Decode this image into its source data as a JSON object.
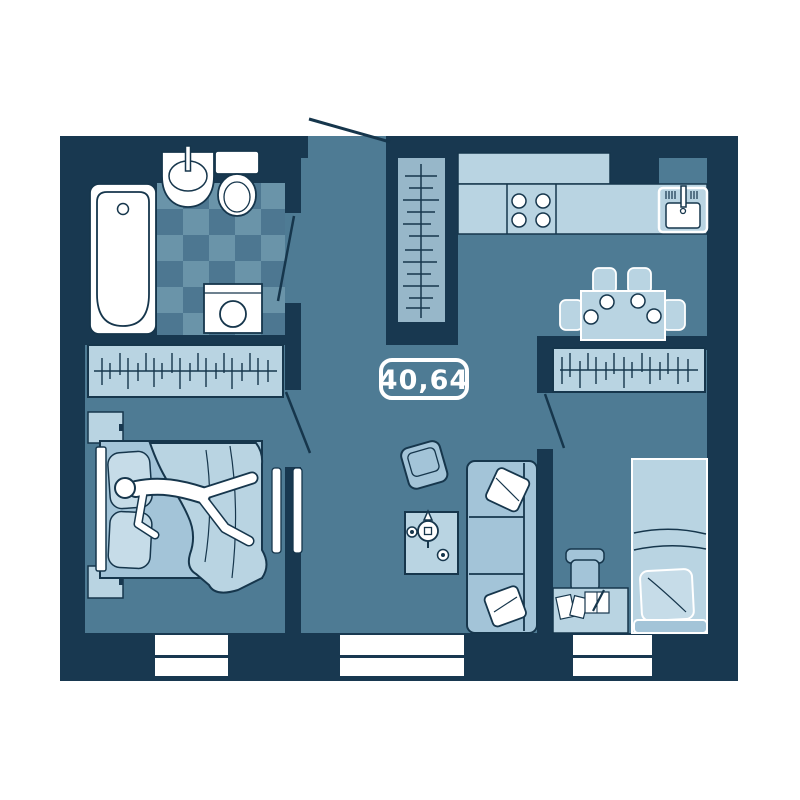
{
  "floor_plan": {
    "area_label": "40,64",
    "colors": {
      "background": "#ffffff",
      "wall": "#183850",
      "floor": "#4e7b94",
      "tile_light": "#6a94a9",
      "tile_dark": "#4d7791",
      "furniture_light": "#b9d4e2",
      "furniture_mid": "#a3c4d8",
      "wardrobe_panel": "#97b7c9",
      "pillow": "#c6dce8",
      "outline": "#16364c",
      "fixture_white": "#ffffff"
    },
    "rooms": [
      {
        "name": "bathroom",
        "icons": [
          "bathtub-icon",
          "sink-icon",
          "toilet-icon",
          "washing-machine-icon",
          "tile-floor",
          "door-swing-icon"
        ]
      },
      {
        "name": "bedroom-left",
        "icons": [
          "wardrobe-icon",
          "double-bed-icon",
          "person-icon",
          "nightstand-icon",
          "nightstand-icon",
          "sliding-door-icon",
          "window-icon"
        ]
      },
      {
        "name": "hallway",
        "icons": [
          "entry-door-swing-icon",
          "wardrobe-icon"
        ]
      },
      {
        "name": "kitchen-living",
        "icons": [
          "upper-cabinet-icon",
          "counter-icon",
          "stove-icon",
          "kitchen-sink-icon",
          "dining-table-icon",
          "chair-icon",
          "plate-icon",
          "armchair-icon",
          "coffee-table-icon",
          "teapot-icon",
          "cup-icon",
          "sofa-icon",
          "pillow-icon",
          "window-icon"
        ]
      },
      {
        "name": "bedroom-right",
        "icons": [
          "wardrobe-icon",
          "door-swing-icon",
          "single-bed-icon",
          "pillow-icon",
          "desk-icon",
          "desk-chair-icon",
          "paper-icon",
          "notebook-icon",
          "pen-icon",
          "window-icon"
        ]
      }
    ]
  }
}
